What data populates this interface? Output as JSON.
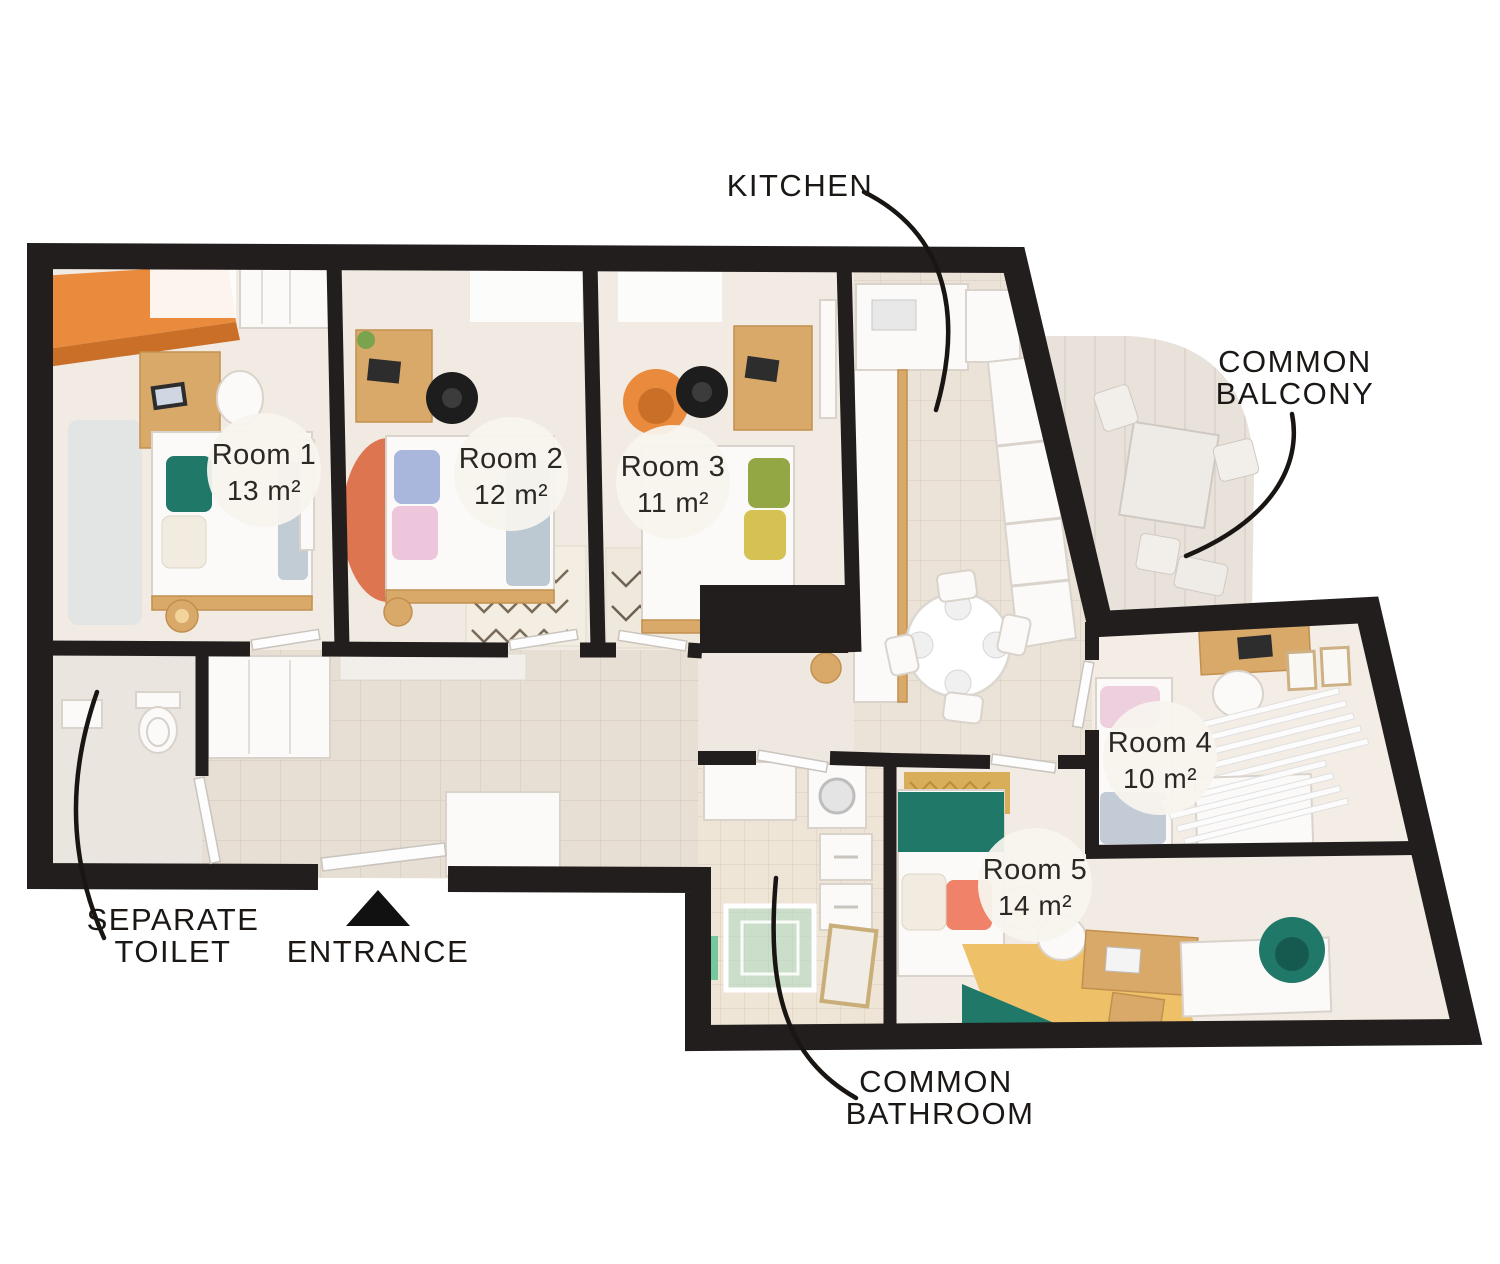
{
  "plan": {
    "callouts": {
      "kitchen": {
        "label": "KITCHEN"
      },
      "balcony": {
        "line1": "COMMON",
        "line2": "BALCONY"
      },
      "separate_toilet": {
        "line1": "SEPARATE",
        "line2": "TOILET"
      },
      "entrance": {
        "label": "ENTRANCE"
      },
      "bathroom": {
        "line1": "COMMON",
        "line2": "BATHROOM"
      }
    },
    "rooms": [
      {
        "name": "Room 1",
        "area": "13 m²"
      },
      {
        "name": "Room 2",
        "area": "12 m²"
      },
      {
        "name": "Room 3",
        "area": "11 m²"
      },
      {
        "name": "Room 4",
        "area": "10 m²"
      },
      {
        "name": "Room 5",
        "area": "14 m²"
      }
    ],
    "colors": {
      "wall": "#221e1d",
      "accent_orange": "#e98a3c",
      "accent_teal": "#1f7868",
      "accent_coral": "#ef8268",
      "accent_yellow": "#eec169",
      "label_ink": "#1a1715"
    }
  }
}
